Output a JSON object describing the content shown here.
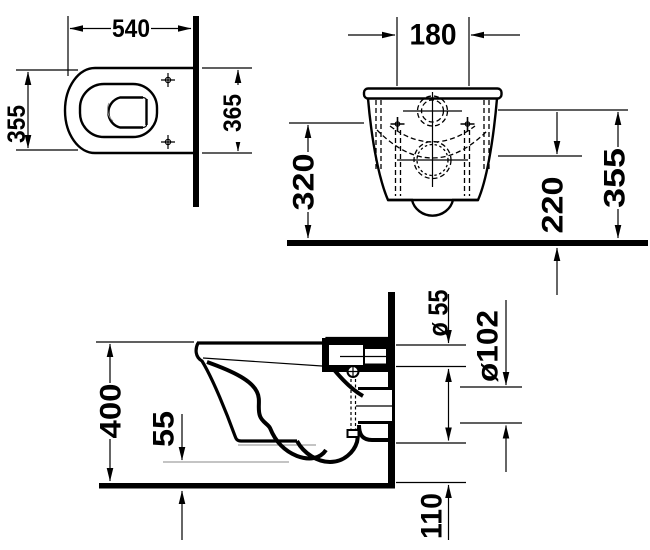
{
  "page": {
    "background": "#ffffff",
    "line_color": "#000000",
    "description": "Wall-hung toilet technical installation drawing with three orthographic views"
  },
  "views": {
    "top": {
      "dim_width": "540",
      "dim_depth": "355",
      "dim_depth_overall": "365"
    },
    "front": {
      "dim_fixing_centers": "180",
      "dim_fixing_height": "320",
      "dim_outlet_center_height": "220",
      "dim_supply_center_height": "355"
    },
    "side": {
      "dim_height": "400",
      "dim_bottom_clearance": "55",
      "dim_supply_pipe_dia": "ø 55",
      "dim_outlet_pipe_dia": "ø102",
      "dim_outlet_bottom_height": "110"
    }
  }
}
